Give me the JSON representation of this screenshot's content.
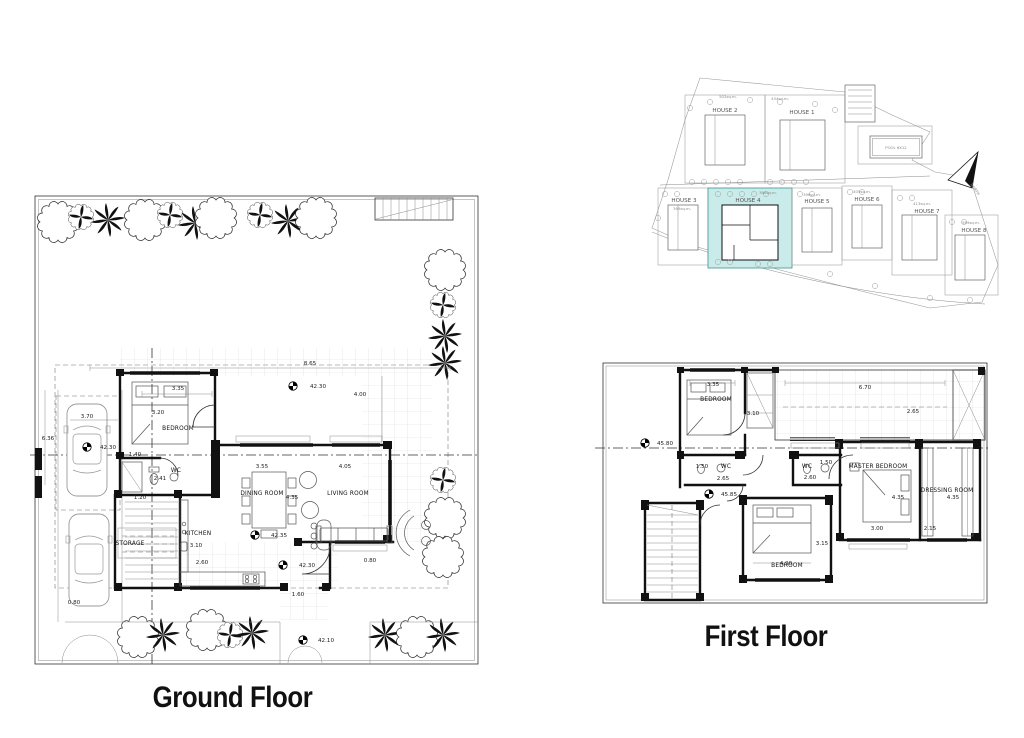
{
  "titles": {
    "ground_floor": "Ground Floor",
    "first_floor": "First Floor"
  },
  "ground_floor": {
    "rooms": {
      "bedroom": "BEDROOM",
      "wc": "WC",
      "storage": "STORAGE",
      "kitchen": "KITCHEN",
      "dining_room": "DINING ROOM",
      "living_room": "LIVING ROOM"
    },
    "dims": {
      "bedroom_w": "3.35",
      "bedroom_h": "3.20",
      "terrace_w": "8.65",
      "terrace_h": "4.00",
      "wc_w": "1.40",
      "wc_h": "2.41",
      "hall_w": "1.20",
      "kitchen_h": "3.10",
      "kitchen_w": "2.60",
      "dining_w": "3.55",
      "dining_h": "4.35",
      "living_w": "4.05",
      "living_edge": "0.80",
      "entry_w": "1.60",
      "drive_w": "3.70",
      "drive_l": "6.36",
      "porch": "0.80"
    },
    "levels": {
      "terrace": "42.30",
      "drive": "42.30",
      "indoor": "42.35",
      "entry": "42.30",
      "gate": "42.10"
    }
  },
  "site_plan": {
    "houses": [
      {
        "name": "HOUSE 1",
        "area": "434sq.m."
      },
      {
        "name": "HOUSE 2",
        "area": "502sq.m."
      },
      {
        "name": "HOUSE 3",
        "area": "395sq.m."
      },
      {
        "name": "HOUSE 4",
        "area": "386sq.m."
      },
      {
        "name": "HOUSE 5",
        "area": "396sq.m."
      },
      {
        "name": "HOUSE 6",
        "area": "405sq.m."
      },
      {
        "name": "HOUSE 7",
        "area": "413sq.m."
      },
      {
        "name": "HOUSE 8",
        "area": "569sq.m."
      }
    ],
    "pool_label": "POOL 6X12",
    "north_label": "NORTH",
    "highlight_color": "#c9ebea"
  },
  "first_floor": {
    "rooms": {
      "bedroom_top": "BEDROOM",
      "wc_left": "WC",
      "wc_right": "WC",
      "master_bedroom": "MASTER BEDROOM",
      "dressing_room": "DRESSING ROOM",
      "bedroom_bottom": "BEDROOM"
    },
    "dims": {
      "bedroom_top_w": "3.35",
      "bedroom_top_h": "3.10",
      "balcony_w": "6.70",
      "balcony_h": "2.65",
      "wc_left_w": "1.50",
      "wc_left_h": "2.65",
      "wc_right_w": "1.50",
      "wc_right_h": "2.60",
      "master_w": "3.00",
      "master_h": "4.35",
      "dressing_w": "2.15",
      "dressing_h": "4.35",
      "bedroom_bottom_w": "4.90",
      "bedroom_bottom_h": "3.15"
    },
    "levels": {
      "roof_terrace": "45.80",
      "floor": "45.85"
    }
  }
}
